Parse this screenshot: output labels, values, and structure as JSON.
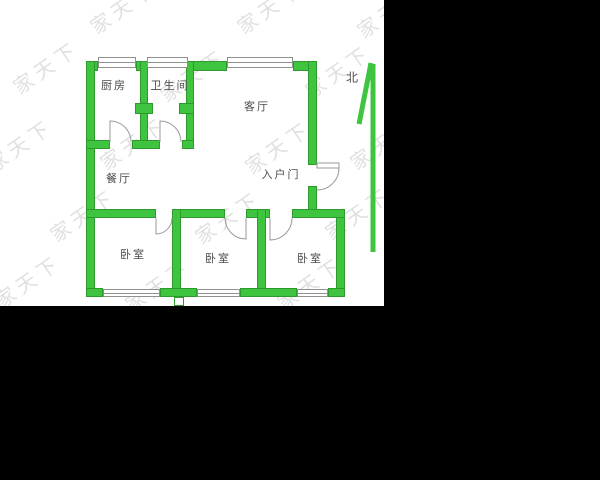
{
  "plan": {
    "rooms": {
      "kitchen": {
        "label": "厨房"
      },
      "bathroom": {
        "label": "卫生间"
      },
      "living": {
        "label": "客厅"
      },
      "dining": {
        "label": "餐厅"
      },
      "entrance": {
        "label": "入户门"
      },
      "bedroom_west": {
        "label": "卧室"
      },
      "bedroom_middle": {
        "label": "卧室"
      },
      "bedroom_east": {
        "label": "卧室"
      }
    },
    "compass": {
      "label": "北"
    },
    "watermark": {
      "text": "家天下"
    },
    "colors": {
      "wall_fill": "#3fc43f",
      "wall_edge": "#2e9a2e",
      "window_line": "#909090",
      "door_line": "#9a9a9a",
      "label_text": "#4a4a4a",
      "watermark_text": "#c3c3c3",
      "mask": "#000000"
    }
  }
}
